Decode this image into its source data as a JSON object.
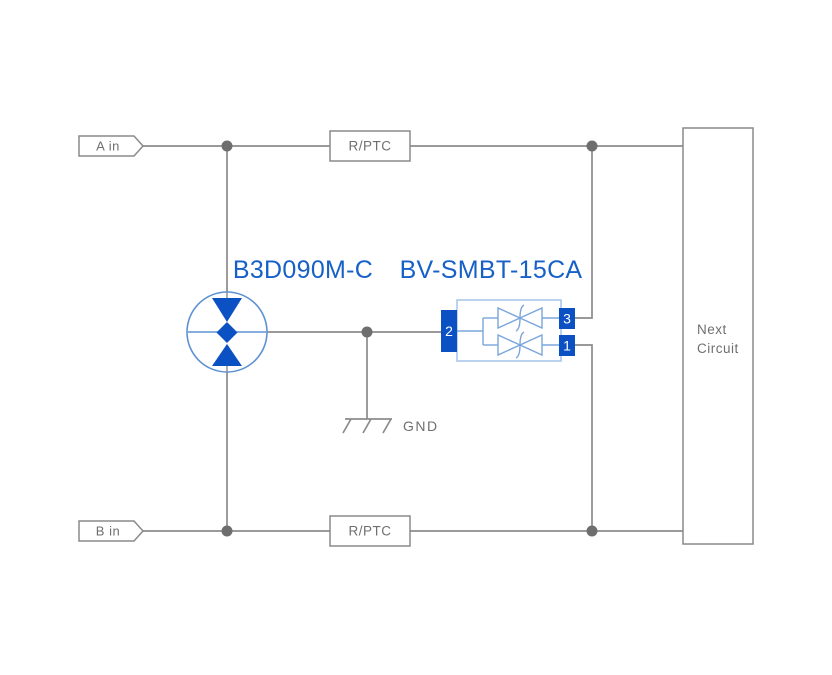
{
  "colors": {
    "background": "#ffffff",
    "wire_gray": "#8b8b8b",
    "border_gray": "#8a8a8a",
    "text_gray": "#6f6f6f",
    "junction_gray": "#6e6e6e",
    "solid_blue": "#0b51c4",
    "title_blue": "#1660c8",
    "light_blue": "#5d92d2",
    "pale_blue": "#aac8ea",
    "inner_blue": "#7aa6dc"
  },
  "diagram": {
    "input_a": "A in",
    "input_b": "B in",
    "fuse_top": "R/PTC",
    "fuse_bottom": "R/PTC",
    "gdt_label": "B3D090M-C",
    "tvs_label": "BV-SMBT-15CA",
    "tvs_pin_left": "2",
    "tvs_pin_top_right": "3",
    "tvs_pin_bottom_right": "1",
    "ground_label": "GND",
    "next_circuit_line1": "Next",
    "next_circuit_line2": "Circuit"
  }
}
